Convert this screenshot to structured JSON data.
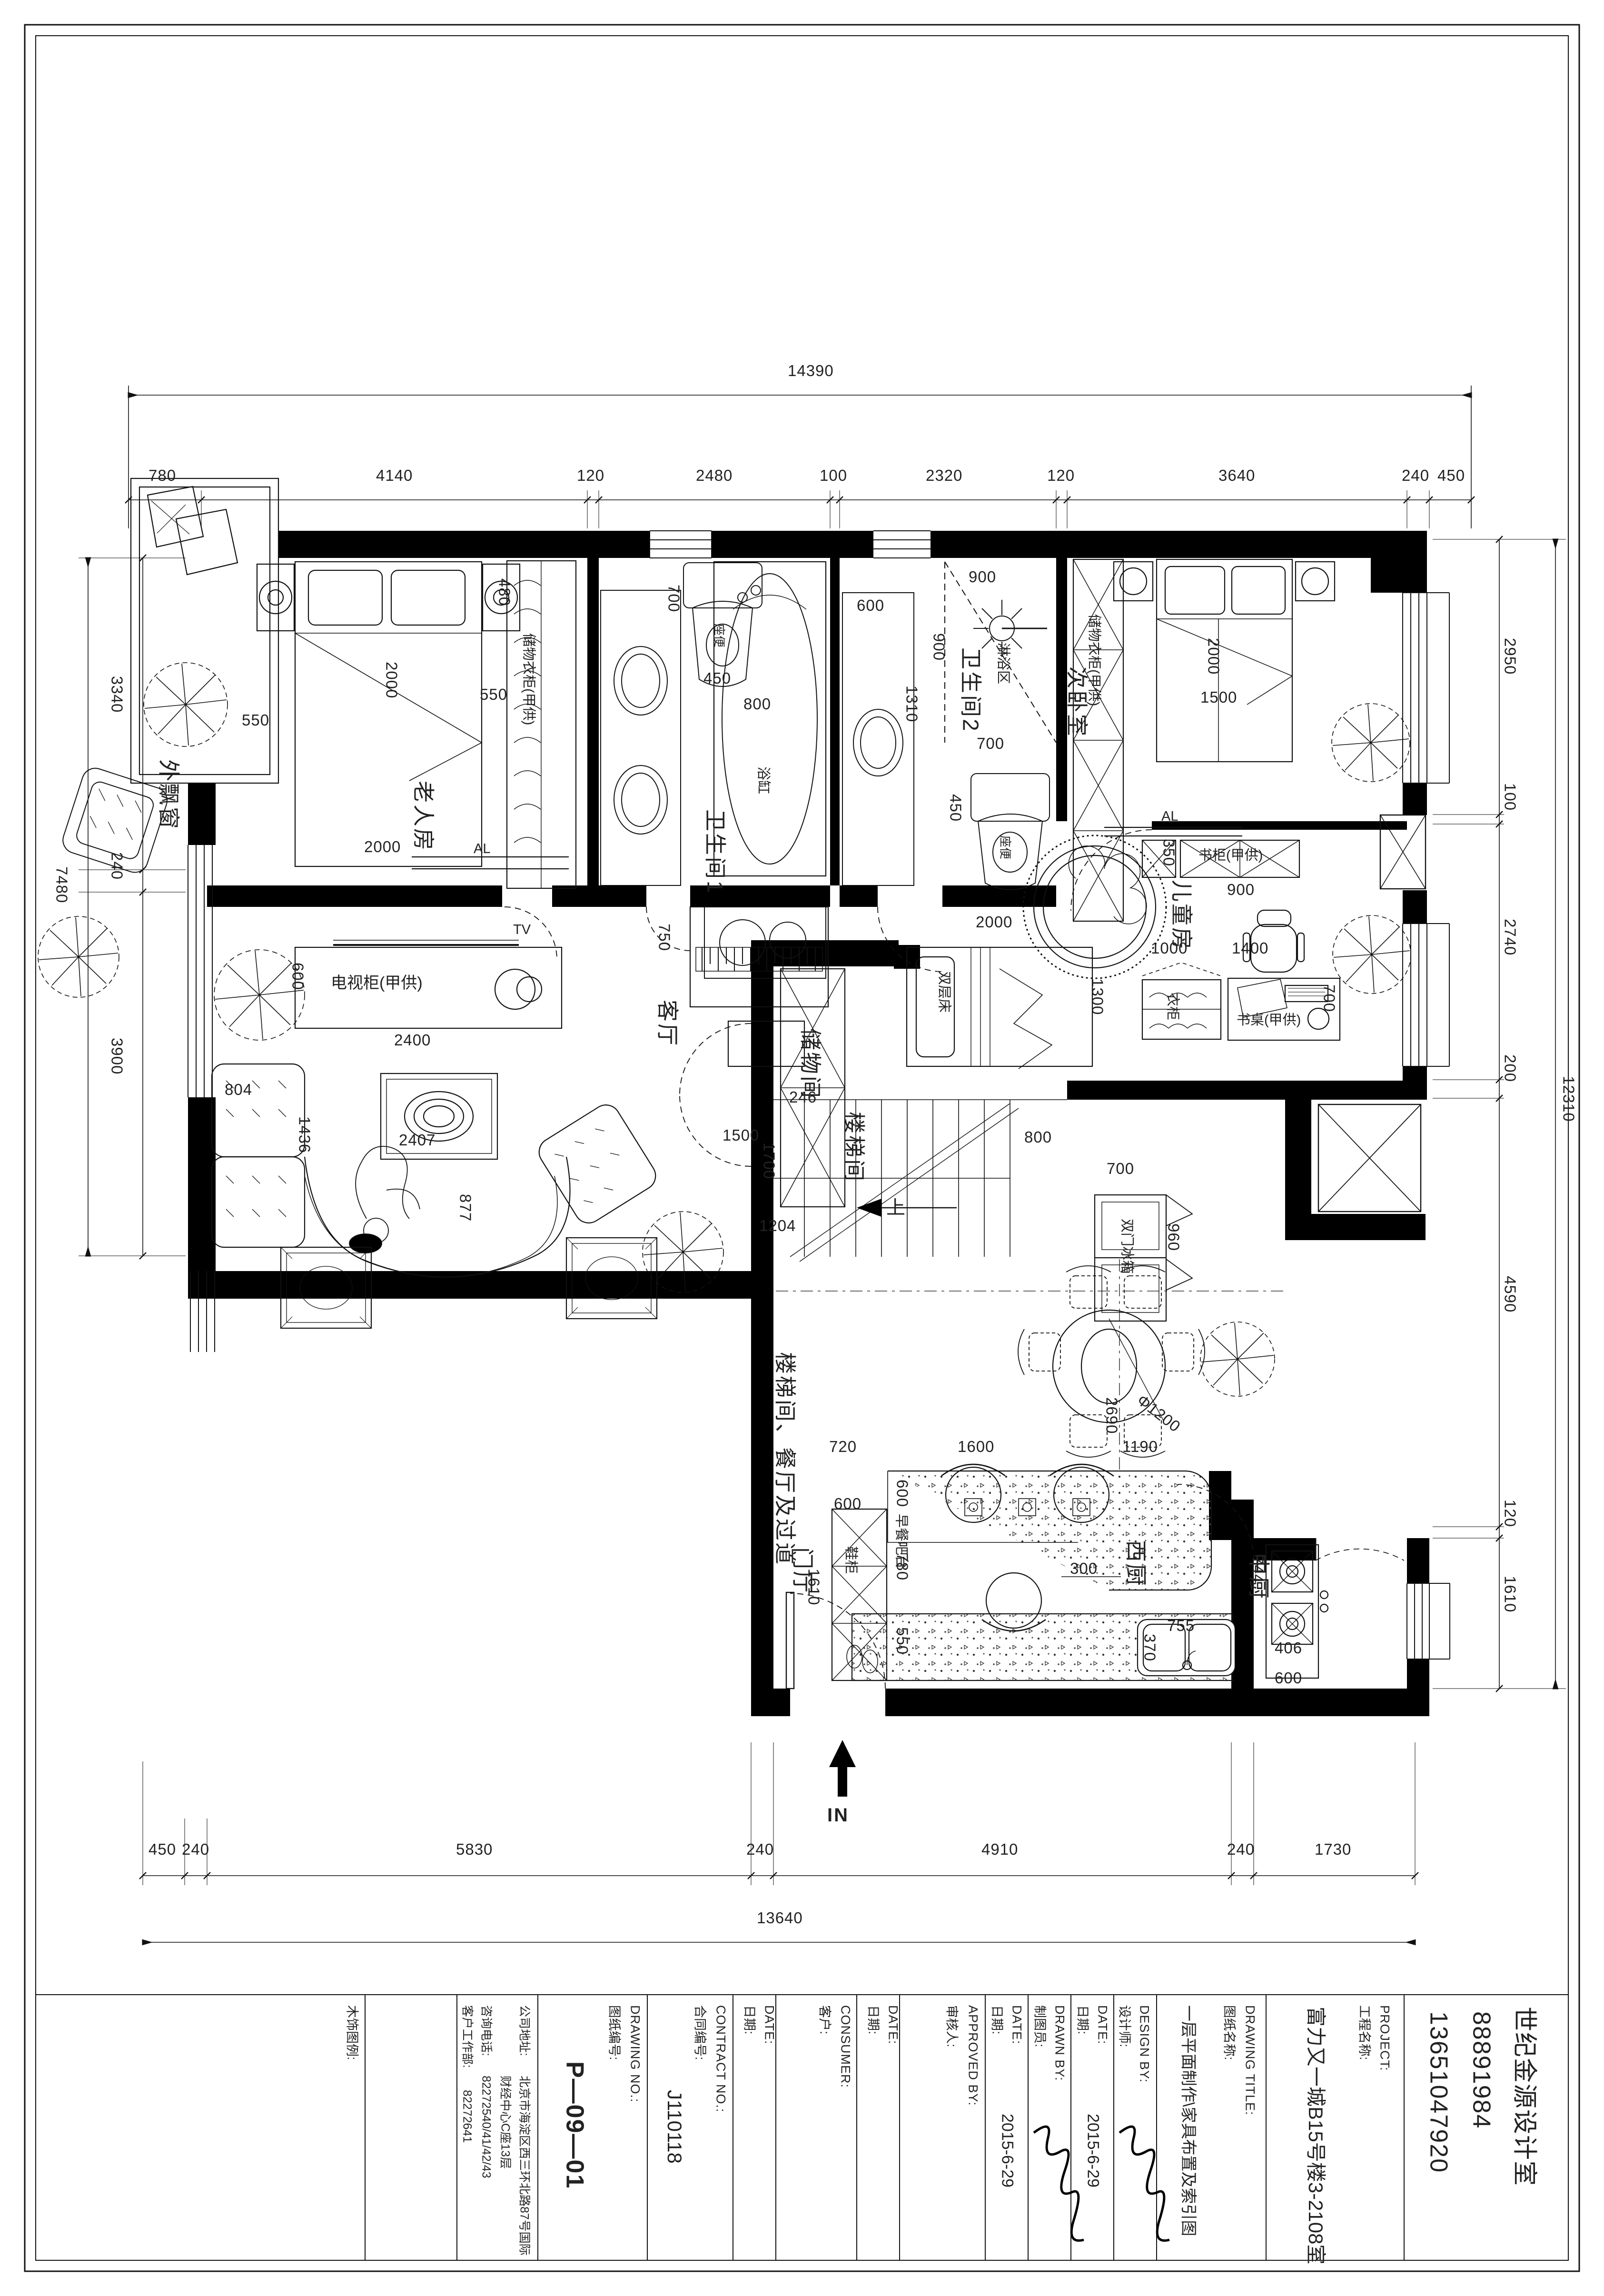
{
  "dims": {
    "top_total": "14390",
    "top_row": [
      "780",
      "4140",
      "120",
      "2480",
      "100",
      "2320",
      "120",
      "3640",
      "240",
      "450"
    ],
    "bottom_row": [
      "450",
      "240",
      "5830",
      "240",
      "4910",
      "240",
      "1730"
    ],
    "bottom_total": "13640",
    "left_row": [
      "3340",
      "240",
      "3900"
    ],
    "left_total": "7480",
    "right_row": [
      "2950",
      "100",
      "2740",
      "200",
      "4590",
      "120",
      "1610"
    ],
    "right_total": "12310"
  },
  "rooms": {
    "bay": "外飘窗",
    "master": "老人房",
    "bath1": "卫生间1",
    "bath2": "卫生间2",
    "bed2": "次卧室",
    "kids": "儿童房",
    "living": "客厅",
    "storage": "储物间",
    "stair": "楼梯间",
    "stair_dining": "楼梯间、餐厅及过道",
    "foyer": "门厅",
    "wkitchen": "西厨",
    "ckitchen": "中厨"
  },
  "furniture": {
    "closet_master": "储物衣柜(甲供)",
    "closet_bed2": "储物衣柜(甲供)",
    "bookcase": "书柜(甲供)",
    "desk": "书桌(甲供)",
    "wardrobe_kids": "衣柜",
    "tv_cabinet": "电视柜(甲供)",
    "tv": "TV",
    "al1": "AL",
    "al2": "AL",
    "bunk": "双层床",
    "fridge": "双门冰箱",
    "shoe": "鞋柜",
    "bar": "早餐吧台",
    "shower": "淋浴区",
    "tub": "浴缸",
    "toilet1": "座便",
    "toilet2": "座便",
    "up": "上",
    "entry": "IN"
  },
  "plan_dims": {
    "master_bed_w": "2000",
    "master_bed_l": "2000",
    "master_550_l": "550",
    "master_550_r": "550",
    "master_480": "480",
    "bath1_700": "700",
    "bath1_450": "450",
    "tub_800": "800",
    "bath2_600": "600",
    "bath2_1310": "1310",
    "bath2_900h": "900",
    "bath2_900v": "900",
    "bath2_700": "700",
    "bath2_450": "450",
    "bed2_2000": "2000",
    "bed2_1500": "1500",
    "bookcase_350": "350",
    "bookcase_900": "900",
    "kids_1000": "1000",
    "kids_1400": "1400",
    "kids_1300": "1300",
    "kids_700": "700",
    "bunk_2000": "2000",
    "stair_246": "246",
    "stair_1700": "1700",
    "stair_800": "800",
    "fridge_700": "700",
    "fridge_960": "960",
    "pass_1204": "1204",
    "table_d": "Φ1200",
    "table_2690": "2690",
    "tv_2400": "2400",
    "tv_600": "600",
    "piano_750": "750",
    "piano_1500": "1500",
    "sofa_804": "804",
    "sofa_1436": "1436",
    "sofa_2407": "2407",
    "sofa_877": "877",
    "wk_720": "720",
    "wk_1600": "1600",
    "wk_1190": "1190",
    "wk_600v": "600",
    "wk_780": "780",
    "wk_550": "550",
    "shoe_600": "600",
    "shoe_1610": "1610",
    "wk_300": "300",
    "sink_755": "755",
    "sink_370": "370",
    "ck_406": "406",
    "ck_600": "600",
    "ck_744": "744"
  },
  "title_block": {
    "studio": "世纪金源设计室",
    "phone1": "88891984",
    "phone2": "13651047920",
    "project_en": "PROJECT:",
    "project_cn": "工程名称:",
    "project_val": "富力又一城B15号楼3-2108室",
    "title_en": "DRAWING TITLE:",
    "title_cn": "图纸名称:",
    "title_val": "一层平面制作\\家具布置及索引图",
    "design_en": "DESIGN BY:",
    "design_cn": "设计师:",
    "date_en": "DATE:",
    "date_cn": "日期:",
    "date1": "2015-6-29",
    "date2": "2015-6-29",
    "drawn_en": "DRAWN BY:",
    "drawn_cn": "制图员:",
    "approved_en": "APPROVED BY:",
    "approved_cn": "审核人:",
    "consumer_en": "CONSUMER:",
    "consumer_cn": "客户:",
    "contract_en": "CONTRACT NO.:",
    "contract_cn": "合同编号:",
    "contract_val": "J110118",
    "dno_en": "DRAWING NO.:",
    "dno_cn": "图纸编号:",
    "dno_val": "P—09—01",
    "addr_label": "公司地址:",
    "addr1": "北京市海淀区西三环北路87号国际",
    "addr2": "财经中心C座13层",
    "tel_label": "咨询电话:",
    "tel_val": "82272540/41/42/43",
    "dept_label": "客户工作部:",
    "dept_val": "82272641",
    "legend": "木饰图例:"
  }
}
